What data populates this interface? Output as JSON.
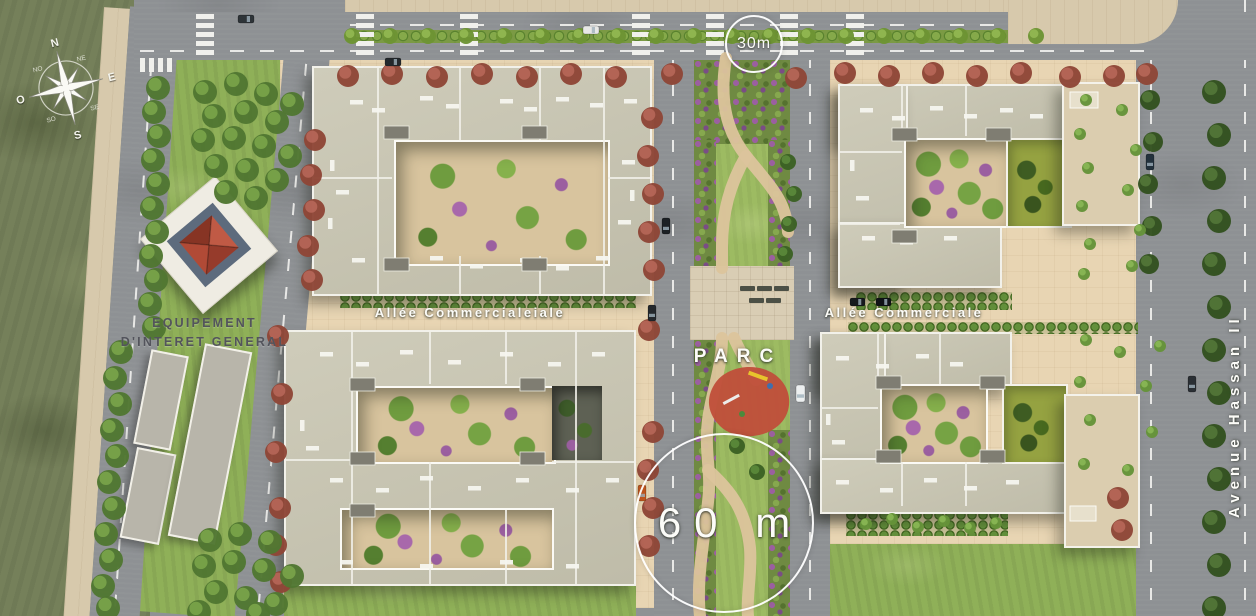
{
  "compass": {
    "n": "N",
    "e": "E",
    "s": "S",
    "o": "O",
    "ne": "NE",
    "se": "SE",
    "so": "SO",
    "no": "NO"
  },
  "labels": {
    "equipment_line1": "EQUIPEMENT",
    "equipment_line2": "D'INTERET GENERAL",
    "alley_left": "Allée Commercialeiale",
    "alley_right": "Allée Commerciale",
    "park": "PARC",
    "avenue": "Avenue Hassan II"
  },
  "measurements": {
    "top_road_width": "30m",
    "central_boulevard_width": "60 m"
  },
  "colors": {
    "grass_field": "#75805a",
    "lawn": "#8fb058",
    "park_lawn": "#9dbb62",
    "road": "#8e9194",
    "sidewalk": "#d7c9ac",
    "plaza": "#e8d5b3",
    "roof": "#c9c6b2",
    "roof_parapet": "#f2f1ea",
    "olive_roof": "#95a241",
    "flower_purple": "#9b5fa0",
    "playground_red": "#bf4f3a",
    "park_path": "#dcc49c",
    "red_tree": "#8e4637",
    "green_tree": "#517732",
    "pyramid_roof_red": "#b14a36",
    "label_white": "#fcfcf8",
    "label_dark": "#53545c"
  }
}
